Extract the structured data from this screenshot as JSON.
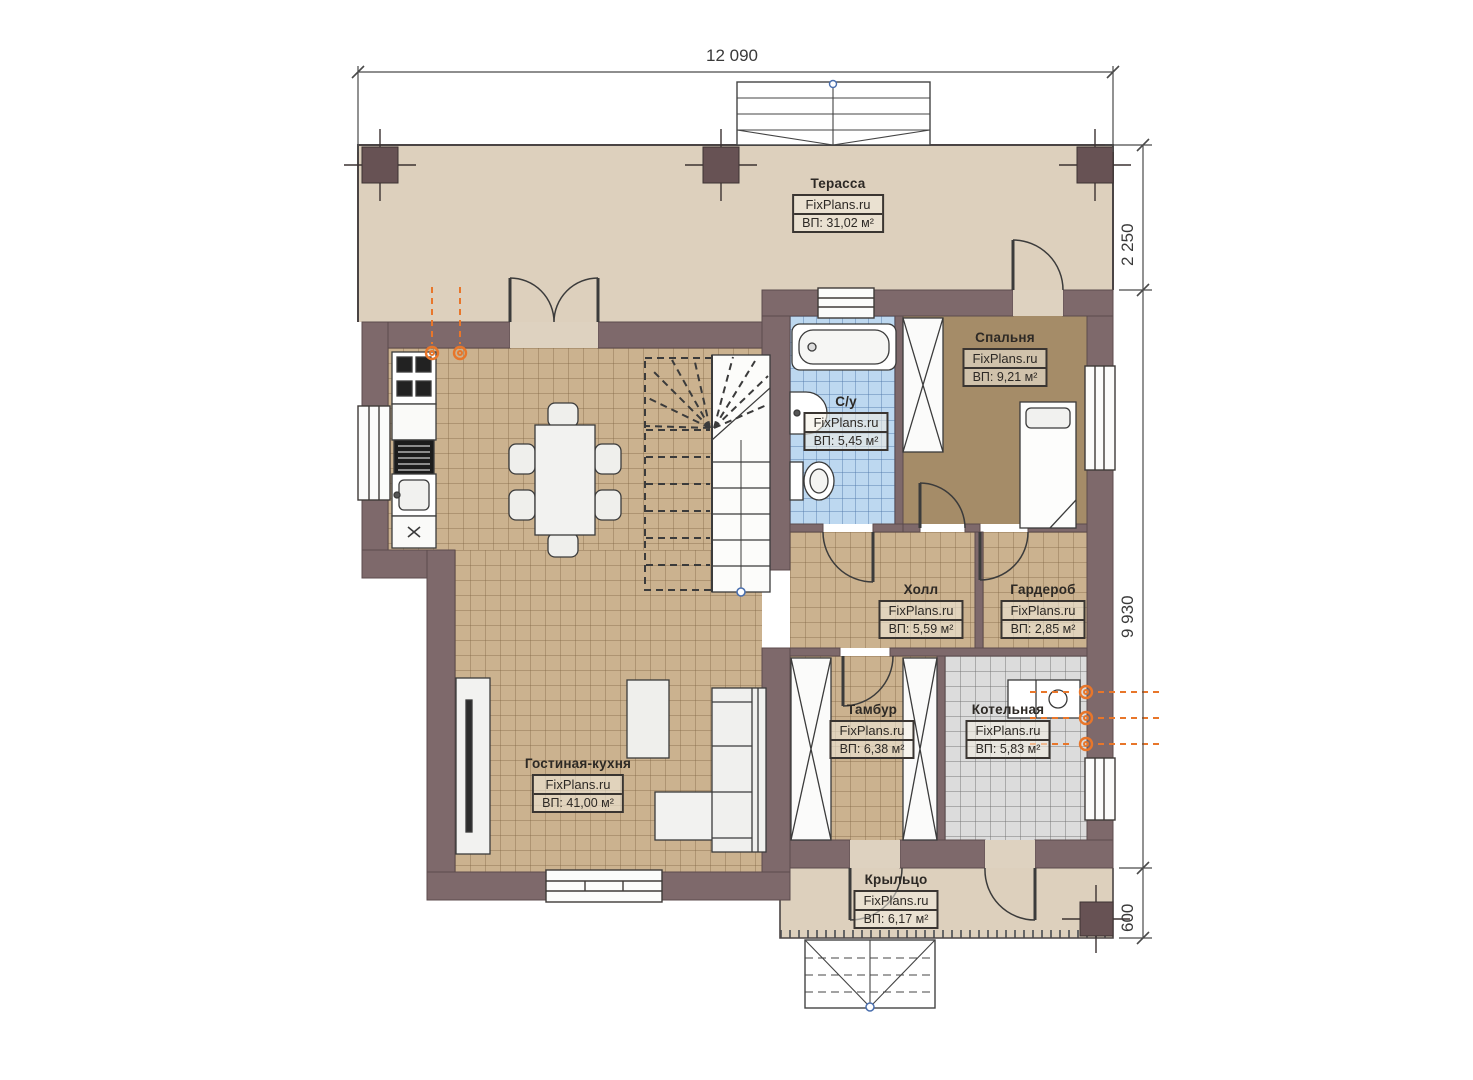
{
  "watermark": "FixPlans.ru",
  "dimensions": {
    "top": "12 090",
    "right_top": "2 250",
    "right_middle": "9 930",
    "right_bottom": "600"
  },
  "rooms": {
    "terrace": {
      "name": "Терасса",
      "area": "ВП: 31,02 м²"
    },
    "bedroom": {
      "name": "Спальня",
      "area": "ВП: 9,21 м²"
    },
    "bathroom": {
      "name": "С/у",
      "area": "ВП: 5,45 м²"
    },
    "hall": {
      "name": "Холл",
      "area": "ВП: 5,59 м²"
    },
    "wardrobe": {
      "name": "Гардероб",
      "area": "ВП: 2,85 м²"
    },
    "vestibule": {
      "name": "Тамбур",
      "area": "ВП: 6,38 м²"
    },
    "boiler": {
      "name": "Котельная",
      "area": "ВП: 5,83 м²"
    },
    "living_kitchen": {
      "name": "Гостиная-кухня",
      "area": "ВП: 41,00 м²"
    },
    "porch": {
      "name": "Крыльцо",
      "area": "ВП: 6,17 м²"
    }
  },
  "colors": {
    "wall": "#7e696b",
    "column": "#675254",
    "floor_tile_tan": "#cbb28f",
    "floor_tile_blue": "#bdd8f0",
    "floor_tile_grey": "#dcdcdc",
    "bedroom_carpet": "#a58c68",
    "terrace_floor": "#ddd0bd",
    "accent_orange": "#e8762a",
    "line": "#3b3b3b"
  }
}
